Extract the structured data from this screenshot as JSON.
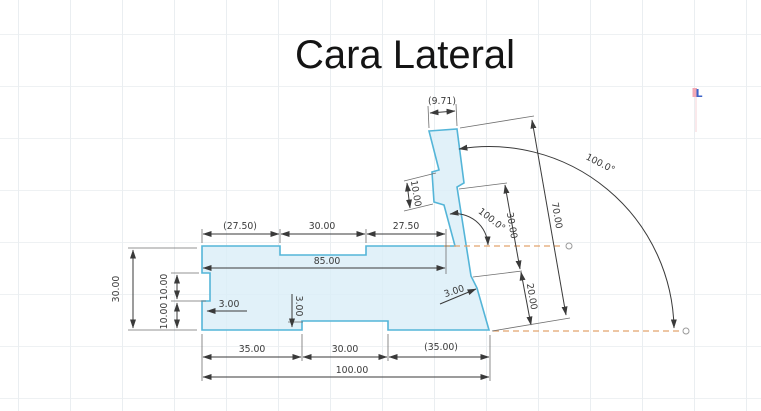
{
  "title": "Cara Lateral",
  "colors": {
    "shape_fill": "#daeef8",
    "shape_stroke": "#54b5d8",
    "dimension": "#3a3a3a",
    "construction": "#e2a36e",
    "grid": "#eaeef1",
    "cursor_blue": "#3c63c8",
    "cursor_pink": "#f2a9b4"
  },
  "marker": {
    "label": "L"
  },
  "dims": {
    "top_width": "(9.71)",
    "col_step": "10.00",
    "angle_inner": "100.0°",
    "angle_outer": "100.0°",
    "slant_30": "30.00",
    "slant_20": "20.00",
    "slant_70": "70.00",
    "top_row": [
      "(27.50)",
      "30.00",
      "27.50"
    ],
    "band": "85.00",
    "left_height": "30.00",
    "left_seg_upper": "10.00",
    "left_seg_lower": "10.00",
    "notch_left": "3.00",
    "step_mid": "3.00",
    "step_right": "3.00",
    "bottom_row": [
      "35.00",
      "30.00",
      "(35.00)"
    ],
    "total_width": "100.00"
  }
}
